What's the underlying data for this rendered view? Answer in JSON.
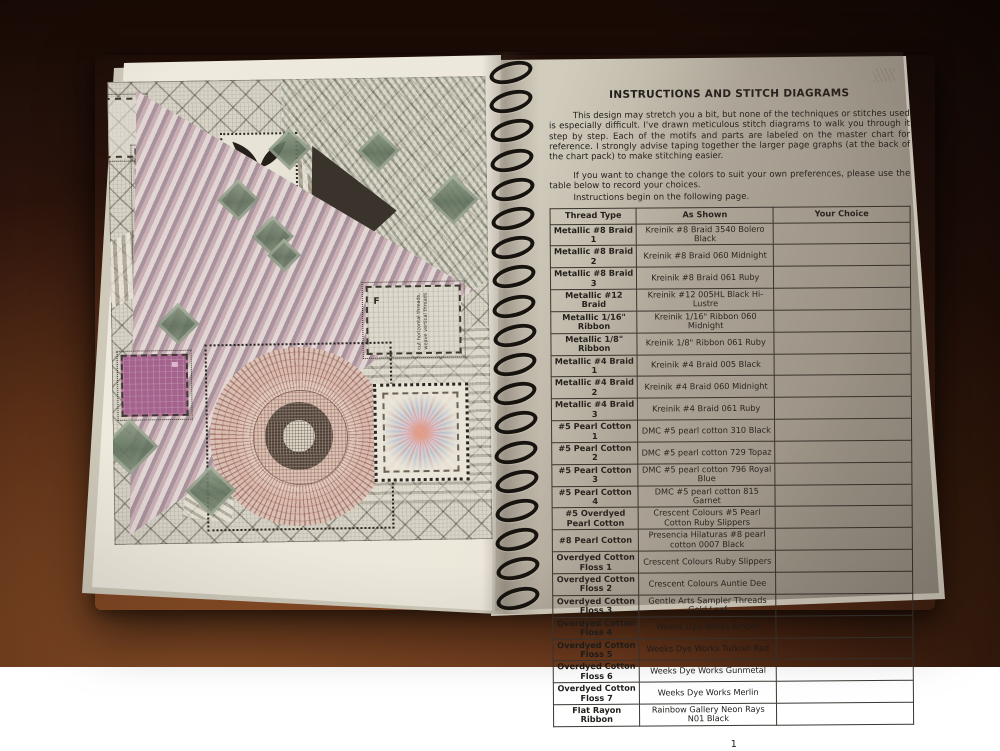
{
  "colors": {
    "wood_dark": "#23100a",
    "wood_light": "#5c2d16",
    "page_cream": "#ece8db",
    "binding_wire": "#17130f",
    "chart_purple": "#a4628c",
    "chart_green": "#6e7f68",
    "chart_maroon": "#70342e"
  },
  "binding": {
    "loop_count": 19
  },
  "left_page": {
    "f_label": "F",
    "f_note": "cut horizontal threads, weave vertical threads"
  },
  "right_page": {
    "title": "INSTRUCTIONS AND STITCH DIAGRAMS",
    "paragraphs": [
      "This design may stretch you a bit, but none of the techniques or stitches used is especially difficult.  I've drawn meticulous stitch diagrams to walk you through it step by step.  Each of the motifs and parts are labeled on the master chart for reference.  I strongly advise taping together the larger page graphs (at the back of the chart pack) to make stitching easier.",
      "If you want to change the colors to suit your own preferences, please use the table below to record your choices.",
      "Instructions begin on the following page."
    ],
    "table": {
      "headers": [
        "Thread Type",
        "As Shown",
        "Your Choice"
      ],
      "rows": [
        {
          "thread_type": "Metallic #8 Braid 1",
          "as_shown": "Kreinik #8 Braid 3540 Bolero Black",
          "your_choice": ""
        },
        {
          "thread_type": "Metallic #8 Braid 2",
          "as_shown": "Kreinik #8 Braid 060 Midnight",
          "your_choice": ""
        },
        {
          "thread_type": "Metallic #8 Braid 3",
          "as_shown": "Kreinik #8 Braid 061 Ruby",
          "your_choice": ""
        },
        {
          "thread_type": "Metallic #12 Braid",
          "as_shown": "Kreinik #12 005HL Black Hi-Lustre",
          "your_choice": ""
        },
        {
          "thread_type": "Metallic 1/16\" Ribbon",
          "as_shown": "Kreinik 1/16\" Ribbon 060 Midnight",
          "your_choice": ""
        },
        {
          "thread_type": "Metallic 1/8\" Ribbon",
          "as_shown": "Kreinik 1/8\" Ribbon 061 Ruby",
          "your_choice": ""
        },
        {
          "thread_type": "Metallic #4 Braid 1",
          "as_shown": "Kreinik #4 Braid 005 Black",
          "your_choice": ""
        },
        {
          "thread_type": "Metallic #4 Braid 2",
          "as_shown": "Kreinik #4 Braid 060 Midnight",
          "your_choice": ""
        },
        {
          "thread_type": "Metallic #4 Braid 3",
          "as_shown": "Kreinik #4 Braid 061 Ruby",
          "your_choice": ""
        },
        {
          "thread_type": "#5 Pearl Cotton 1",
          "as_shown": "DMC #5 pearl cotton 310 Black",
          "your_choice": ""
        },
        {
          "thread_type": "#5 Pearl Cotton 2",
          "as_shown": "DMC #5 pearl cotton 729 Topaz",
          "your_choice": ""
        },
        {
          "thread_type": "#5 Pearl Cotton 3",
          "as_shown": "DMC #5 pearl cotton 796 Royal Blue",
          "your_choice": ""
        },
        {
          "thread_type": "#5 Pearl Cotton 4",
          "as_shown": "DMC #5 pearl cotton 815 Garnet",
          "your_choice": ""
        },
        {
          "thread_type": "#5 Overdyed Pearl Cotton",
          "as_shown": "Crescent Colours #5 Pearl Cotton Ruby Slippers",
          "your_choice": ""
        },
        {
          "thread_type": "#8 Pearl Cotton",
          "as_shown": "Presencia Hilaturas #8 pearl cotton 0007 Black",
          "your_choice": ""
        },
        {
          "thread_type": "Overdyed Cotton Floss 1",
          "as_shown": "Crescent Colours Ruby Slippers",
          "your_choice": ""
        },
        {
          "thread_type": "Overdyed Cotton Floss 2",
          "as_shown": "Crescent Colours Auntie Dee",
          "your_choice": ""
        },
        {
          "thread_type": "Overdyed Cotton Floss 3",
          "as_shown": "Gentle Arts Sampler Threads Gold Leaf",
          "your_choice": ""
        },
        {
          "thread_type": "Overdyed Cotton Floss 4",
          "as_shown": "Weeks Dye Works Amber",
          "your_choice": ""
        },
        {
          "thread_type": "Overdyed Cotton Floss 5",
          "as_shown": "Weeks Dye Works Turkish Red",
          "your_choice": ""
        },
        {
          "thread_type": "Overdyed Cotton Floss 6",
          "as_shown": "Weeks Dye Works Gunmetal",
          "your_choice": ""
        },
        {
          "thread_type": "Overdyed Cotton Floss 7",
          "as_shown": "Weeks Dye Works Merlin",
          "your_choice": ""
        },
        {
          "thread_type": "Flat Rayon Ribbon",
          "as_shown": "Rainbow Gallery Neon Rays N01 Black",
          "your_choice": ""
        }
      ]
    },
    "page_number": "1"
  }
}
